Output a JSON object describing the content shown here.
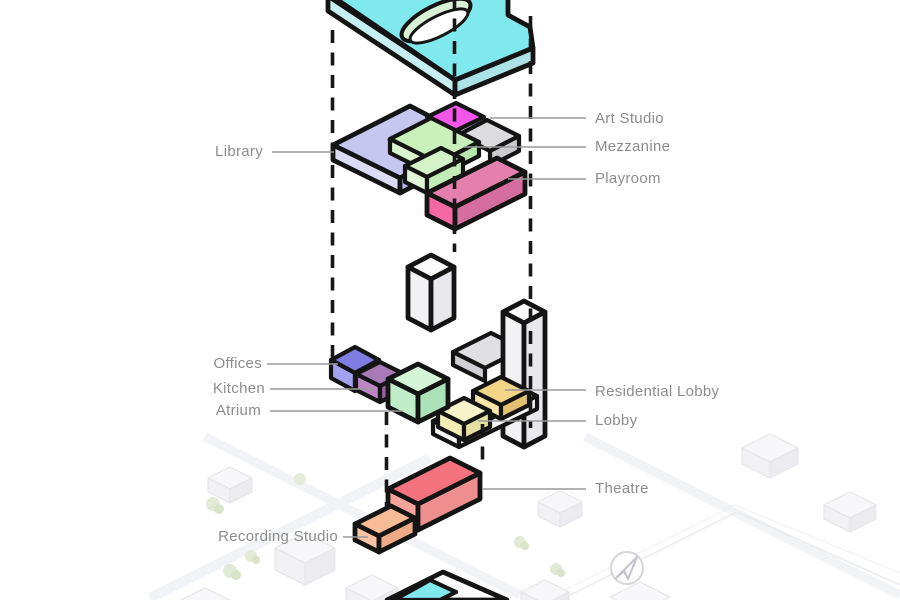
{
  "diagram": {
    "kind": "Exploded axonometric building program diagram",
    "map": {
      "compass": "arrow-northeast"
    }
  },
  "style": {
    "outline": "#141414",
    "label_text": "#8c8c8c",
    "leader_line": "#9a9a9a",
    "dash_line": "#171717"
  },
  "roof": {
    "top": "#7fe9ed",
    "side_left": "#c6eff1",
    "side_right": "#abe3e7",
    "notch": "#cdeff0",
    "skylight_rim": "#d9f2d5",
    "skylight_void": "#ffffff"
  },
  "rooms": [
    {
      "id": "library",
      "label": "Library",
      "faces": {
        "top": "#c6c6f0",
        "left": "#dbdbf6",
        "right": "#b9b9e8"
      }
    },
    {
      "id": "art_studio",
      "label": "Art Studio",
      "faces": {
        "top": "#f356e8"
      }
    },
    {
      "id": "mezzanine",
      "label": "Mezzanine",
      "faces": {
        "top": "#c9f0bb",
        "left": "#daf5cd",
        "right": "#b5e8ac",
        "step_top": "#d4f3c8",
        "step_left": "#e2f7d8",
        "step_right": "#c3edb6"
      }
    },
    {
      "id": "playroom",
      "label": "Playroom",
      "faces": {
        "top": "#e57fae",
        "end": "#f468a4",
        "front": "#d66d9f"
      }
    },
    {
      "id": "offices",
      "label": "Offices",
      "faces": {
        "top": "#7e7ee2",
        "left": "#a2a2f0",
        "right": "#8b8be0"
      }
    },
    {
      "id": "kitchen",
      "label": "Kitchen",
      "faces": {
        "top": "#a87ab8",
        "left": "#bd85c4",
        "right": "#95619f"
      }
    },
    {
      "id": "atrium",
      "label": "Atrium",
      "faces": {
        "top": "#d3f4d6",
        "left": "#c0edc8",
        "right": "#abe2b8"
      }
    },
    {
      "id": "residential_lobby",
      "label": "Residential Lobby",
      "faces": {
        "top": "#f2d586",
        "left": "#f6e5a8",
        "right": "#e3c170"
      }
    },
    {
      "id": "lobby",
      "label": "Lobby",
      "faces": {
        "top": "#f8f4ca",
        "left": "#f3edb6",
        "right": "#e6dfa2"
      }
    },
    {
      "id": "theatre",
      "label": "Theatre",
      "faces": {
        "top": "#f4737f",
        "end": "#f5a49b",
        "front": "#ee8e8e"
      }
    },
    {
      "id": "recording_studio",
      "label": "Recording Studio",
      "faces": {
        "top": "#f7bb96",
        "end": "#f8c4a4",
        "front": "#eeab85"
      }
    }
  ],
  "structures": {
    "tower": {
      "top": "#fcfcfd",
      "left": "#f2f2f4",
      "right": "#e9e9ed"
    },
    "gray_block": {
      "top": "#dcdcde",
      "side": "#cbcbcf"
    },
    "ramp": {
      "top": "#e0e0e3",
      "side": "#d0d0d4"
    },
    "base_slab": {
      "top": "#ffffff",
      "side": "#f6f6f8"
    },
    "ground_footprint": {
      "plate": "#ffffff",
      "pool": "#7fe9ed"
    }
  }
}
